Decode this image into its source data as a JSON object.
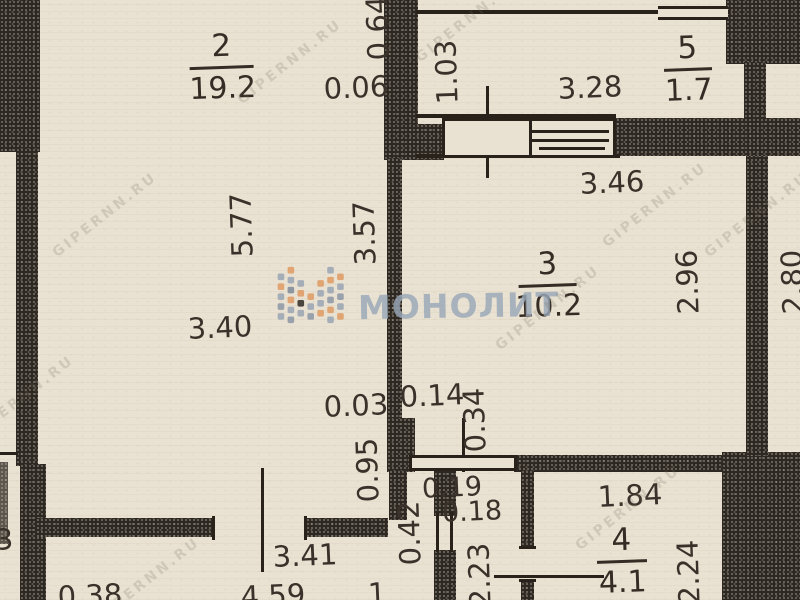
{
  "document_title": "apartment floor plan scan",
  "colors": {
    "paper": "#e9e1d1",
    "ink": "#3a322a",
    "wall": "#2e2822",
    "brand_blue_gray": "#98a7b8",
    "brand_orange": "#df9b62"
  },
  "watermark": {
    "brand_text": "МОНОЛИТ",
    "brand_logo": "dotted-M-monogram",
    "tile_text": "GIPERNN.RU"
  },
  "rooms": [
    {
      "number": "2",
      "area": "19.2"
    },
    {
      "number": "5",
      "area": "1.7"
    },
    {
      "number": "3",
      "area": "10.2"
    },
    {
      "number": "4",
      "area": "4.1"
    }
  ],
  "dims": {
    "v064": "0.64",
    "h006": "0.06",
    "v103": "1.03",
    "h328": "3.28",
    "h346": "3.46",
    "v577": "5.77",
    "v357": "3.57",
    "v296": "2.96",
    "v280": "2.80",
    "h340": "3.40",
    "h003": "0.03",
    "h014": "0.14",
    "v034": "0.34",
    "v095": "0.95",
    "h019": "0.19",
    "h018": "0.18",
    "v042": "0.42",
    "h184": "1.84",
    "v223": "2.23",
    "v224": "2.24",
    "h341": "3.41",
    "h459": "4.59",
    "h1": "1",
    "h038": "0.38",
    "h3": "3"
  }
}
